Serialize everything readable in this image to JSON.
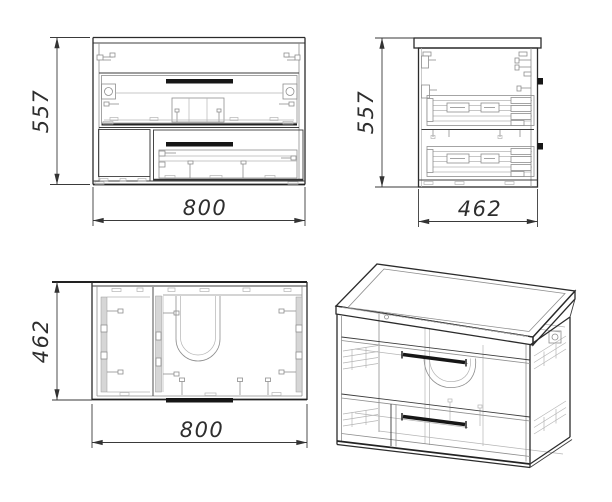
{
  "drawing": {
    "views": {
      "front": {
        "label": "front-view",
        "height": "557",
        "width": "800"
      },
      "side": {
        "label": "side-view",
        "height": "557",
        "width": "462"
      },
      "top": {
        "label": "top-view",
        "height": "462",
        "width": "800"
      },
      "isometric": {
        "label": "isometric-view"
      }
    },
    "colors": {
      "background": "#ffffff",
      "outline": "#2b2b2b",
      "detail": "#8e8e8e",
      "dimension": "#3a3a3a",
      "handle": "#161616",
      "panel_fill": "#d6d6d6"
    }
  }
}
